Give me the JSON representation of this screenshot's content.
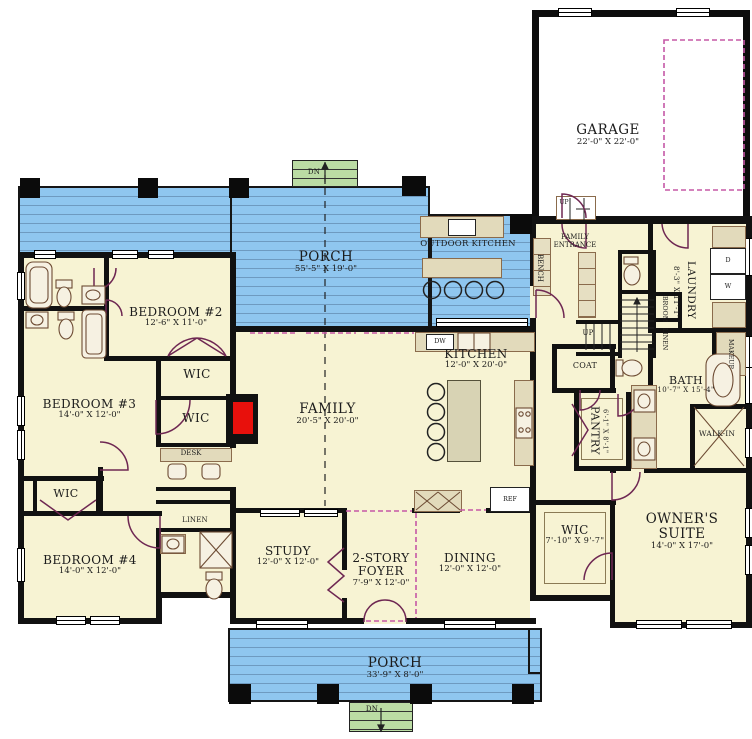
{
  "colors": {
    "porch_blue": "#8FC6EF",
    "room_cream": "#F7F3D3",
    "wall_black": "#111111",
    "door_plum": "#6E2752",
    "dashed_magenta": "#C558A6",
    "steps_green": "#BBDCA4",
    "counter_tan": "#E2DABB",
    "fireplace_red": "#E8100C"
  },
  "rooms": [
    {
      "name": "GARAGE",
      "dims": "22'-0\" X 22'-0\""
    },
    {
      "name": "PORCH",
      "dims": "55'-5\" X 19'-0\""
    },
    {
      "name": "BEDROOM #2",
      "dims": "12'-6\" X 11'-0\""
    },
    {
      "name": "BEDROOM #3",
      "dims": "14'-0\" X 12'-0\""
    },
    {
      "name": "BEDROOM #4",
      "dims": "14'-0\" X 12'-0\""
    },
    {
      "name": "FAMILY",
      "dims": "20'-5\" X 20'-0\""
    },
    {
      "name": "KITCHEN",
      "dims": "12'-0\" X 20'-0\""
    },
    {
      "name": "STUDY",
      "dims": "12'-0\" X 12'-0\""
    },
    {
      "name": "2-STORY FOYER",
      "dims": "7'-9\" X 12'-0\""
    },
    {
      "name": "DINING",
      "dims": "12'-0\" X 12'-0\""
    },
    {
      "name": "WIC",
      "dims": "7'-10\" X 9'-7\""
    },
    {
      "name": "OWNER'S SUITE",
      "dims": "14'-0\" X 17'-0\""
    },
    {
      "name": "BATH",
      "dims": "10'-7\" X 15'-4\""
    },
    {
      "name": "PANTRY",
      "dims": "6'-1\" X 8'-1\""
    },
    {
      "name": "LAUNDRY",
      "dims": "8'-3\" X 11'-1\""
    },
    {
      "name": "PORCH",
      "dims": "33'-9\" X 8'-0\""
    }
  ],
  "labels": {
    "outdoor_kitchen": "OUTDOOR KITCHEN",
    "family_entrance": "FAMILY ENTRANCE",
    "bench": "BENCH",
    "coat": "COAT",
    "desk": "DESK",
    "wic": "WIC",
    "linen": "LINEN",
    "broom": "BROOM",
    "makeup": "MAKEUP",
    "walk_in": "WALK-IN",
    "dw": "DW",
    "ref": "REF",
    "dryer": "D",
    "washer": "W",
    "up": "UP",
    "dn": "DN"
  }
}
